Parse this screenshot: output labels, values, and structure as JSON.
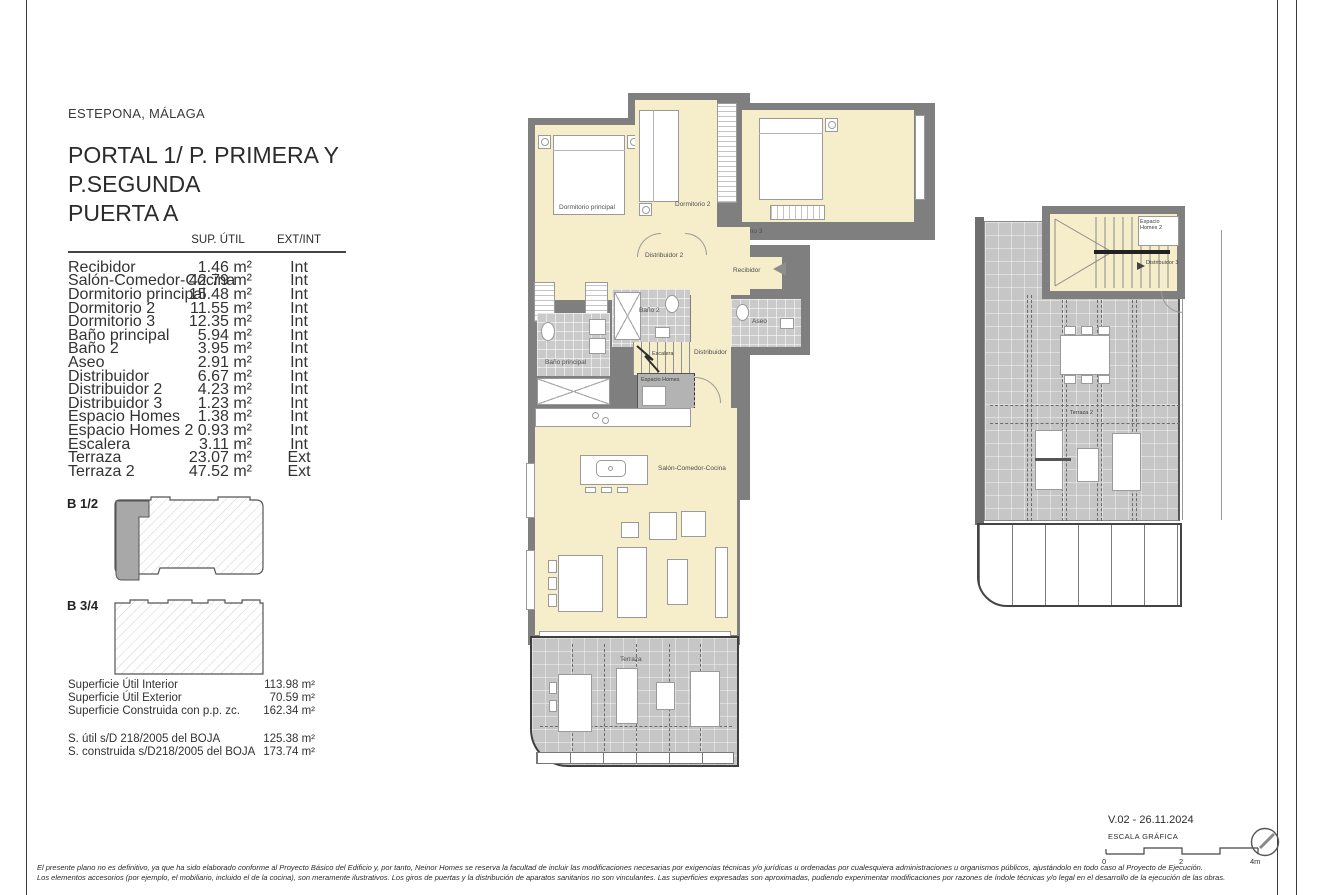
{
  "page": {
    "location": "ESTEPONA, MÁLAGA",
    "title_line1": "PORTAL 1/ P. PRIMERA Y",
    "title_line2": "P.SEGUNDA",
    "title_line3": "PUERTA A"
  },
  "table": {
    "col_area": "SUP. ÚTIL",
    "col_type": "EXT/INT",
    "rows": [
      {
        "name": "Recibidor",
        "area": "1.46 m²",
        "type": "Int"
      },
      {
        "name": "Salón-Comedor-Cocina",
        "area": "42.79 m²",
        "type": "Int"
      },
      {
        "name": "Dormitorio principal",
        "area": "15.48 m²",
        "type": "Int"
      },
      {
        "name": "Dormitorio 2",
        "area": "11.55 m²",
        "type": "Int"
      },
      {
        "name": "Dormitorio 3",
        "area": "12.35 m²",
        "type": "Int"
      },
      {
        "name": "Baño principal",
        "area": "5.94 m²",
        "type": "Int"
      },
      {
        "name": "Baño 2",
        "area": "3.95 m²",
        "type": "Int"
      },
      {
        "name": "Aseo",
        "area": "2.91 m²",
        "type": "Int"
      },
      {
        "name": "Distribuidor",
        "area": "6.67 m²",
        "type": "Int"
      },
      {
        "name": "Distribuidor 2",
        "area": "4.23 m²",
        "type": "Int"
      },
      {
        "name": "Distribuidor 3",
        "area": "1.23 m²",
        "type": "Int"
      },
      {
        "name": "Espacio Homes",
        "area": "1.38 m²",
        "type": "Int"
      },
      {
        "name": "Espacio Homes 2",
        "area": "0.93 m²",
        "type": "Int"
      },
      {
        "name": "Escalera",
        "area": "3.11 m²",
        "type": "Int"
      },
      {
        "name": "Terraza",
        "area": "23.07 m²",
        "type": "Ext"
      },
      {
        "name": "Terraza 2",
        "area": "47.52 m²",
        "type": "Ext"
      }
    ]
  },
  "blocks": {
    "b12": "B 1/2",
    "b34": "B 3/4"
  },
  "summary": {
    "rows": [
      {
        "label": "Superficie Útil Interior",
        "value": "113.98 m²"
      },
      {
        "label": "Superficie Útil Exterior",
        "value": "70.59 m²"
      },
      {
        "label": "Superficie Construida con p.p. zc.",
        "value": "162.34 m²"
      }
    ],
    "boja": [
      {
        "label": "S. útil s/D 218/2005 del BOJA",
        "value": "125.38 m²"
      },
      {
        "label": "S. construida s/D218/2005 del BOJA",
        "value": "173.74 m²"
      }
    ]
  },
  "plan_main": {
    "dormitorio_principal": "Dormitorio principal",
    "dormitorio_2": "Dormitorio 2",
    "dormitorio_3": "Dormitorio 3",
    "distribuidor_2": "Distribuidor 2",
    "recibidor": "Recibidor",
    "banio_principal": "Baño principal",
    "banio_2": "Baño 2",
    "aseo": "Aseo",
    "escalera": "Escalera",
    "distribuidor": "Distribuidor",
    "espacio_homes": "Espacio Homes",
    "salon": "Salón-Comedor-Cocina",
    "terraza": "Terraza"
  },
  "plan_upper": {
    "espacio_homes_2": "Espacio Homes 2",
    "distribuidor_3": "Distribuidor 3",
    "terraza_2": "Terraza 2"
  },
  "footer": {
    "version": "V.02 - 26.11.2024",
    "scale_label": "ESCALA GRÁFICA",
    "tick_0": "0",
    "tick_2": "2",
    "tick_4": "4m",
    "disclaimer_line1": "El presente plano no es definitivo, ya que ha sido elaborado conforme al Proyecto Básico del Edificio y, por tanto, Neinor Homes se reserva la facultad de incluir las modificaciones necesarias por exigencias técnicas y/o jurídicas u ordenadas por cualesquiera administraciones u organismos públicos, ajustándolo en todo caso al Proyecto de Ejecución.",
    "disclaimer_line2": "Los elementos accesorios (por ejemplo, el mobiliario, incluido el de la cocina), son meramente ilustrativos. Los giros de puertas y la distribución de aparatos sanitarios no son vinculantes. Las superficies expresadas son aproximadas, pudiendo experimentar modificaciones por razones de índole técnicas y/o legal en el desarrollo de la ejecución de las obras."
  },
  "colors": {
    "room_fill": "#f6eeca",
    "wall": "#7f7f7f",
    "bath_tile": "#cacaca",
    "terrace": "#c6c6c6",
    "site_highlight": "#a8a8a8"
  }
}
